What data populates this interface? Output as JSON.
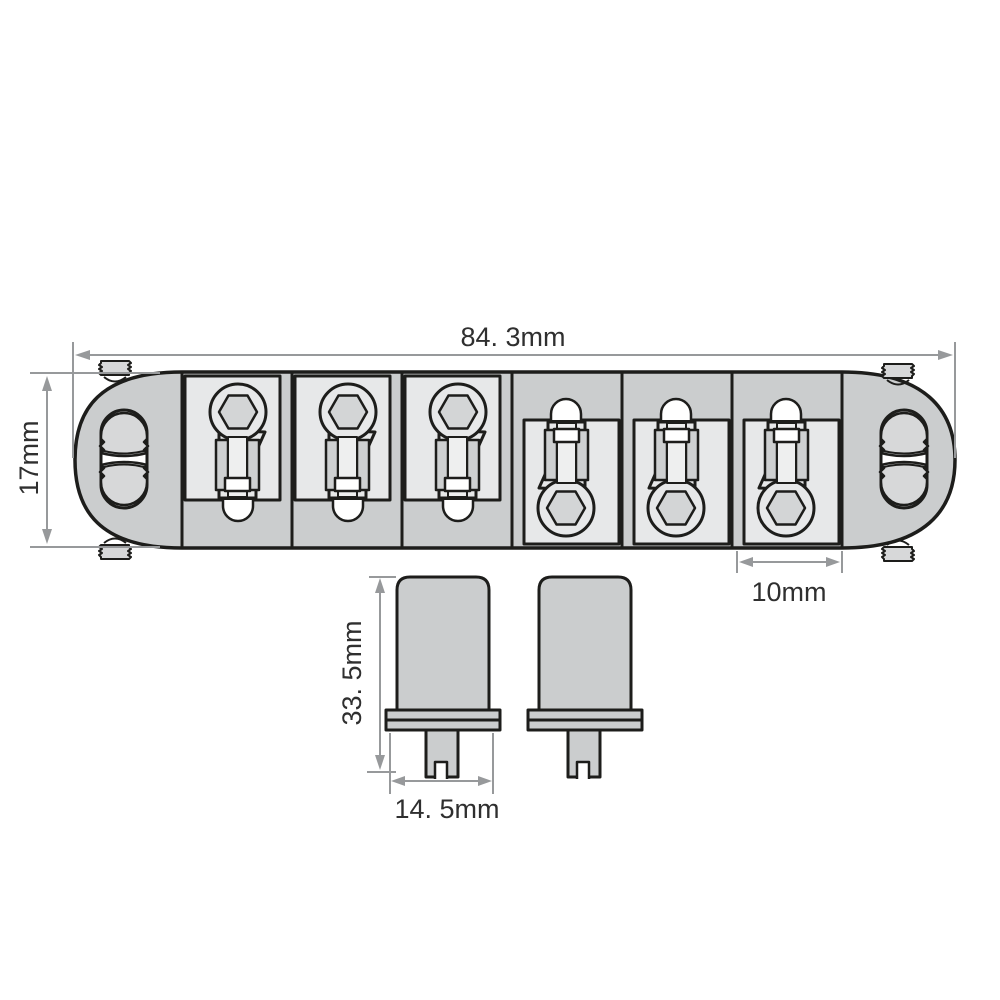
{
  "figure": {
    "subject": "bridge-dimension-diagram",
    "labels": {
      "overall_length": "84. 3mm",
      "body_width": "17mm",
      "saddle_width": "10mm",
      "post_height": "33. 5mm",
      "post_flange_width": "14. 5mm"
    },
    "colors": {
      "background": "#ffffff",
      "outline": "#1d1d1b",
      "body_fill": "#cbcdce",
      "saddle_block_fill": "#e7e8e9",
      "hex_socket_fill": "#d3d5d6",
      "dimension_line": "#97999b",
      "label_text": "#2f2f2f"
    }
  }
}
